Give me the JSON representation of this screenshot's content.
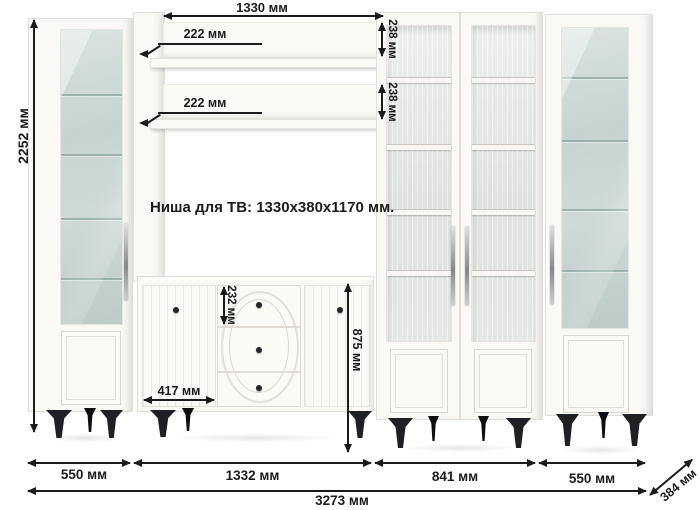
{
  "niche": {
    "label": "Ниша для ТВ: 1330x380x1170 мм."
  },
  "dims": {
    "height_total": "2252 мм",
    "niche_width": "1330 мм",
    "shelf_depth_1": "222 мм",
    "shelf_depth_2": "222 мм",
    "shelf_back_height_1": "238 мм",
    "shelf_back_height_2": "238 мм",
    "drawer_height": "232 мм",
    "stand_door_width": "417 мм",
    "stand_height": "875 мм",
    "left_cabinet_width": "550 мм",
    "tv_section_width": "1332 мм",
    "double_cabinet_width": "841 мм",
    "right_cabinet_width": "550 мм",
    "total_width": "3273 мм",
    "depth": "384 мм"
  },
  "colors": {
    "bg": "#ffffff",
    "furn": "#faf9f6",
    "edge": "#e2ded7",
    "glass_teal": "#c8d5d2",
    "glass_line": "#8ea6a1",
    "glass_gray": "#e2e5e2",
    "shelf_white": "#f7f6f3",
    "metal": "#9fa3a6",
    "leg": "#1f2023",
    "dim": "#1b1b1b"
  }
}
